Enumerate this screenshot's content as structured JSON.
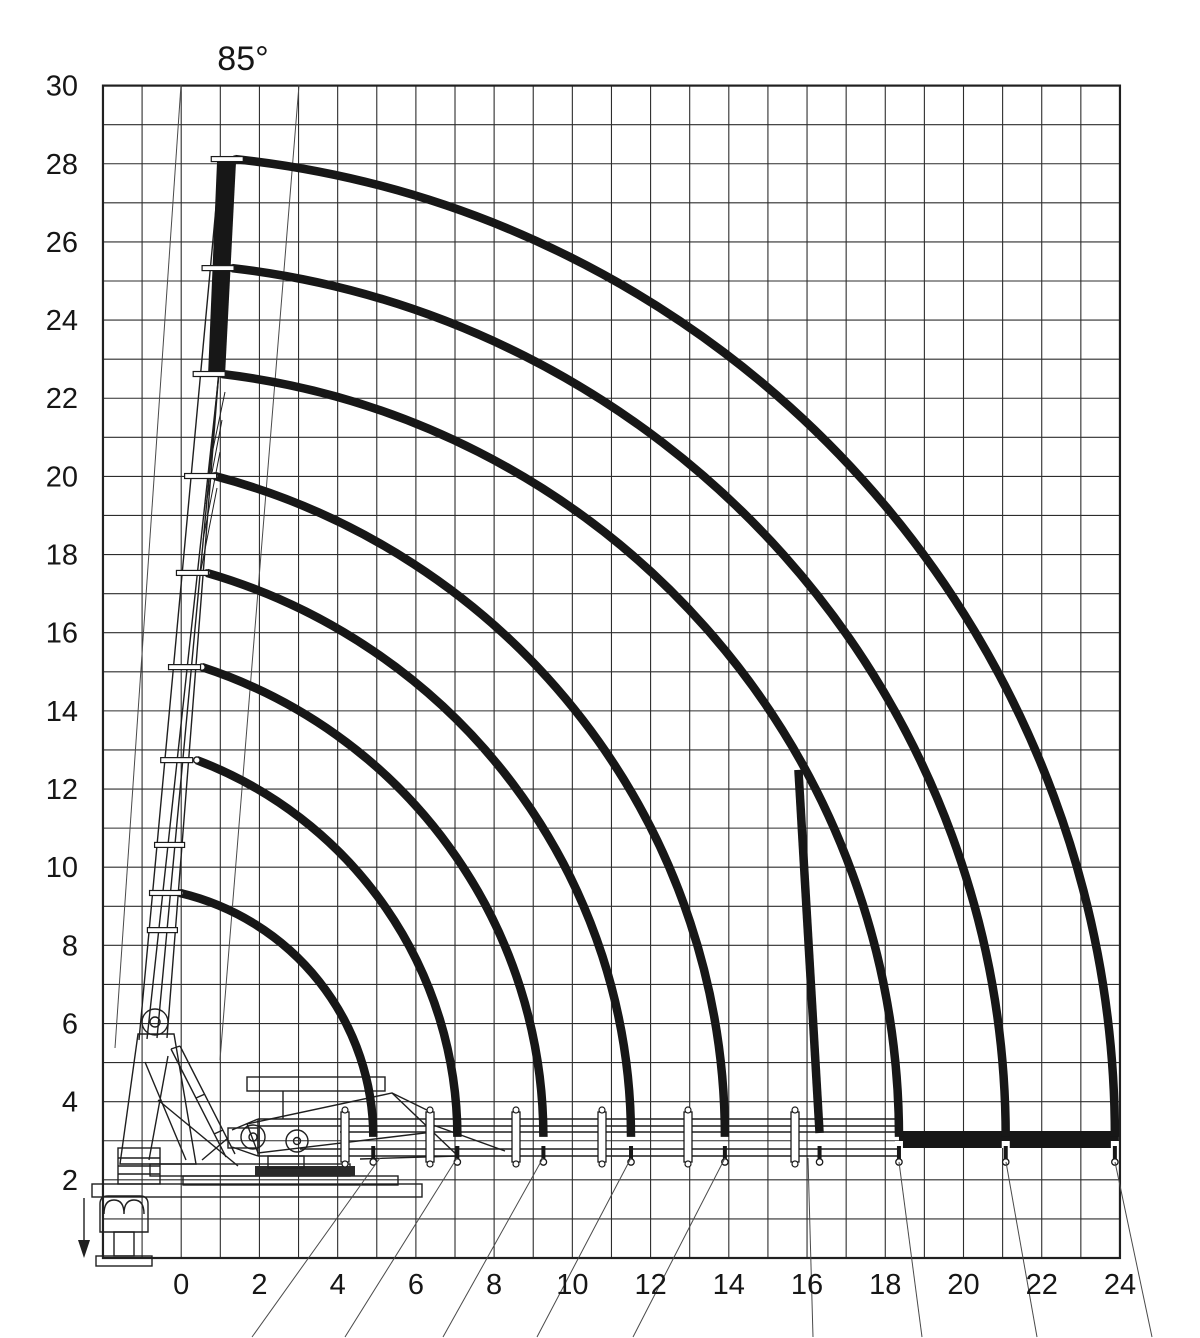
{
  "page": {
    "background": "#ffffff",
    "ink": "#1a1a1a"
  },
  "angle_label": "85°",
  "chart_data": {
    "type": "line",
    "title": "Crane working envelope diagram (telescopic boom reach curves)",
    "boom_angle_label": "85°",
    "units": "m",
    "grid": "on",
    "legend": "none",
    "x_axis": {
      "tick_labels": [
        0,
        2,
        4,
        6,
        8,
        10,
        12,
        14,
        16,
        18,
        20,
        22,
        24
      ],
      "range": [
        -2,
        24
      ],
      "gridline_step": 1
    },
    "y_axis": {
      "tick_labels": [
        30,
        28,
        26,
        24,
        22,
        20,
        18,
        16,
        14,
        12,
        10,
        8,
        6,
        4,
        2
      ],
      "range": [
        0,
        30
      ],
      "gridline_step": 1
    },
    "pivot": {
      "x": -1.3,
      "y": 3.1
    },
    "reach_curves": [
      {
        "name": "extension-8",
        "tip_x": 1.38,
        "tip_y": 28.12,
        "end_x": 23.87
      },
      {
        "name": "extension-7",
        "tip_x": 1.3,
        "tip_y": 25.33,
        "end_x": 21.08
      },
      {
        "name": "extension-6",
        "tip_x": 1.04,
        "tip_y": 22.62,
        "end_x": 18.35
      },
      {
        "name": "extension-5",
        "tip_x": 0.86,
        "tip_y": 20.01,
        "end_x": 13.9
      },
      {
        "name": "extension-4",
        "tip_x": 0.66,
        "tip_y": 17.53,
        "end_x": 11.5
      },
      {
        "name": "extension-3",
        "tip_x": 0.53,
        "tip_y": 15.12,
        "end_x": 9.26
      },
      {
        "name": "extension-2",
        "tip_x": 0.4,
        "tip_y": 12.74,
        "end_x": 7.06
      },
      {
        "name": "extension-1",
        "tip_x": -0.03,
        "tip_y": 9.34,
        "end_x": 4.91
      }
    ],
    "limit_line": {
      "x1": 15.78,
      "y1": 12.49,
      "x2": 16.32,
      "y2": 3.2
    },
    "solid_boom_bar": {
      "from_x": 18.35,
      "to_x": 23.87,
      "y": 3.1
    },
    "boom_section_marks_y": [
      10.57,
      8.39
    ],
    "boom_clamp_px": [
      345,
      430,
      516,
      602,
      688,
      795
    ],
    "angle_wedge_lines_px": [
      {
        "x1": 181,
        "y1": 85,
        "x2": 115,
        "y2": 1048
      },
      {
        "x1": 299,
        "y1": 85,
        "x2": 220,
        "y2": 1060
      }
    ],
    "callout_lines_px": [
      {
        "x1": 380,
        "y1": 1158,
        "x2": 252,
        "y2": 1337
      },
      {
        "x1": 457,
        "y1": 1158,
        "x2": 345,
        "y2": 1337
      },
      {
        "x1": 543,
        "y1": 1158,
        "x2": 443,
        "y2": 1337
      },
      {
        "x1": 631,
        "y1": 1158,
        "x2": 537,
        "y2": 1337
      },
      {
        "x1": 725,
        "y1": 1158,
        "x2": 633,
        "y2": 1337
      },
      {
        "x1": 808,
        "y1": 1158,
        "x2": 813,
        "y2": 1337
      },
      {
        "x1": 899,
        "y1": 1162,
        "x2": 922,
        "y2": 1337
      },
      {
        "x1": 1006,
        "y1": 1162,
        "x2": 1037,
        "y2": 1337
      },
      {
        "x1": 1115,
        "y1": 1162,
        "x2": 1152,
        "y2": 1337
      }
    ]
  }
}
